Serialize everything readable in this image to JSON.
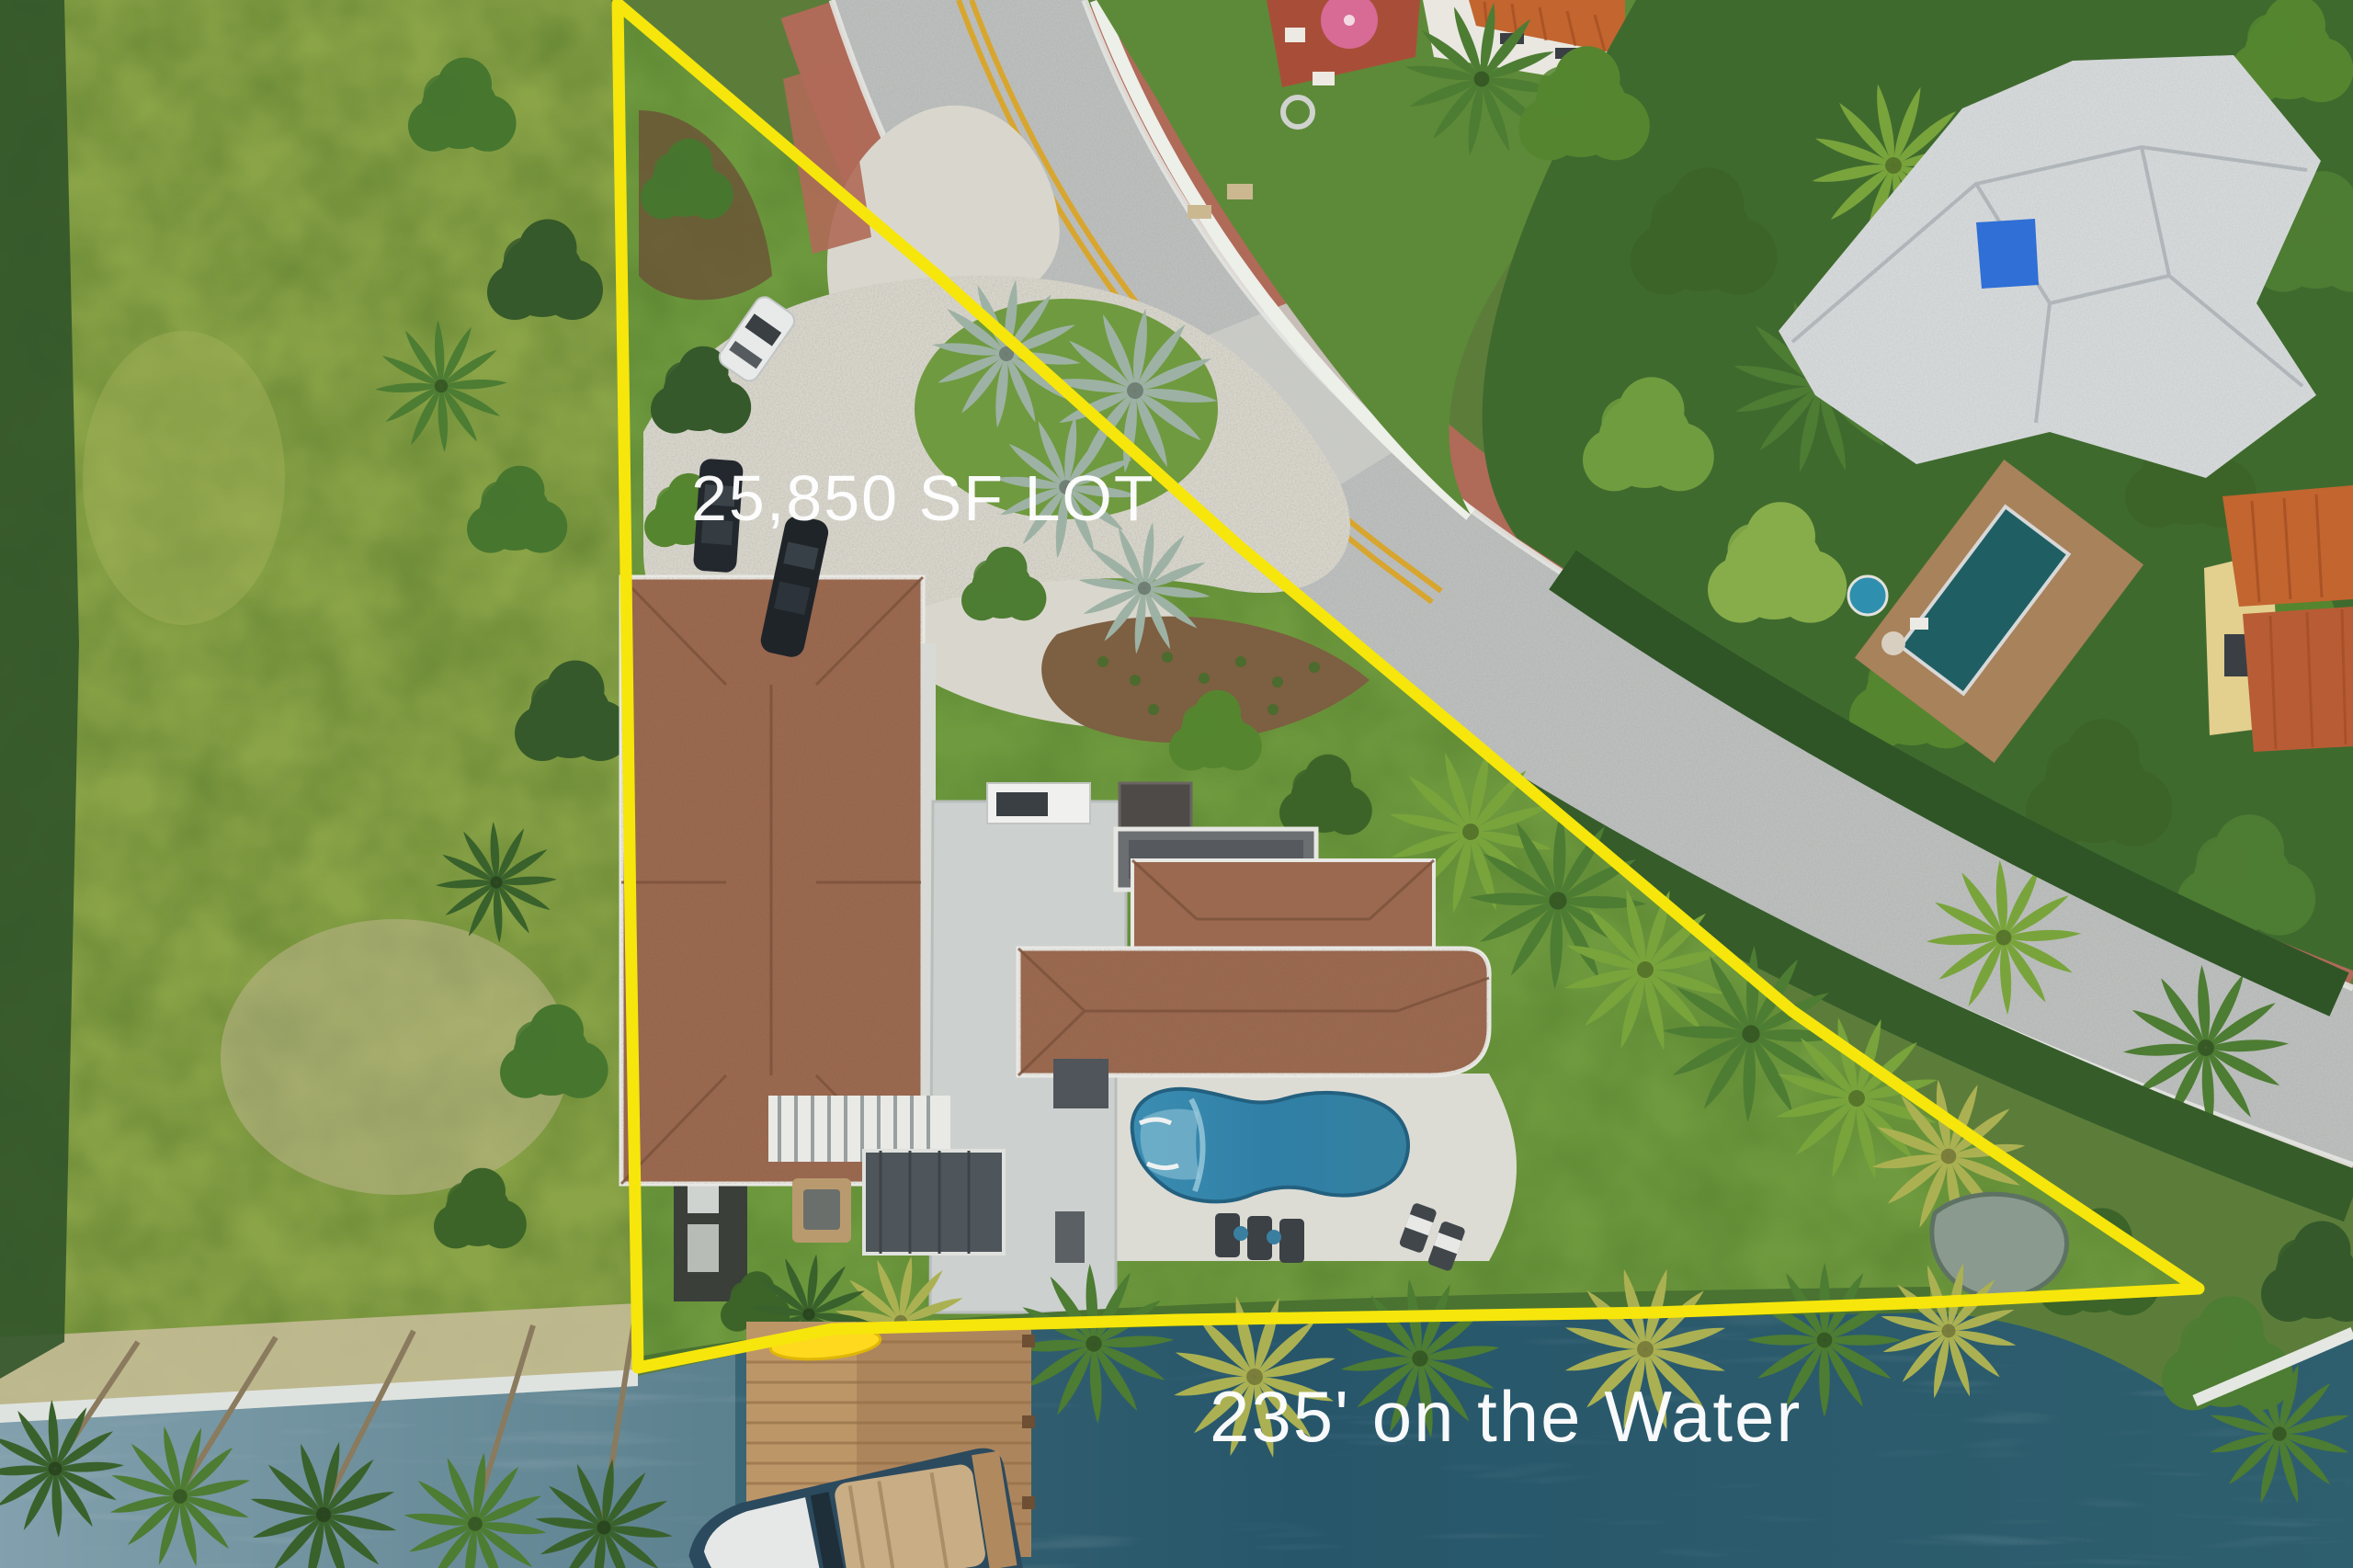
{
  "annotations": {
    "lot_size": "25,850 SF LOT",
    "waterfront": "235' on the Water"
  },
  "palette": {
    "boundary_yellow": "#f6e60b",
    "label_white": "#ffffff",
    "water_deep": "#27566a",
    "water_mid": "#30616f",
    "water_light": "#7e9dab",
    "grass_field": "#8ba448",
    "lawn": "#6f9a3f",
    "road_asphalt": "#bcbfbd",
    "sidewalk_brick": "#b06a58",
    "wall_white": "#edefe9",
    "gravel_drive": "#d9d7cd",
    "mulch_brown": "#7d5f41",
    "roof_terracotta": "#9a6950",
    "roof_white": "#d6d9da",
    "roof_flat_light": "#ccd0cf",
    "roof_dark": "#4e555b",
    "pool_blue": "#2f7fa6",
    "deck_white": "#dddcd4",
    "dock_wood": "#ad855c",
    "roof_orange": "#c2652f",
    "boat_hull": "#2c4a5e",
    "boat_trim": "#c8ad85"
  }
}
